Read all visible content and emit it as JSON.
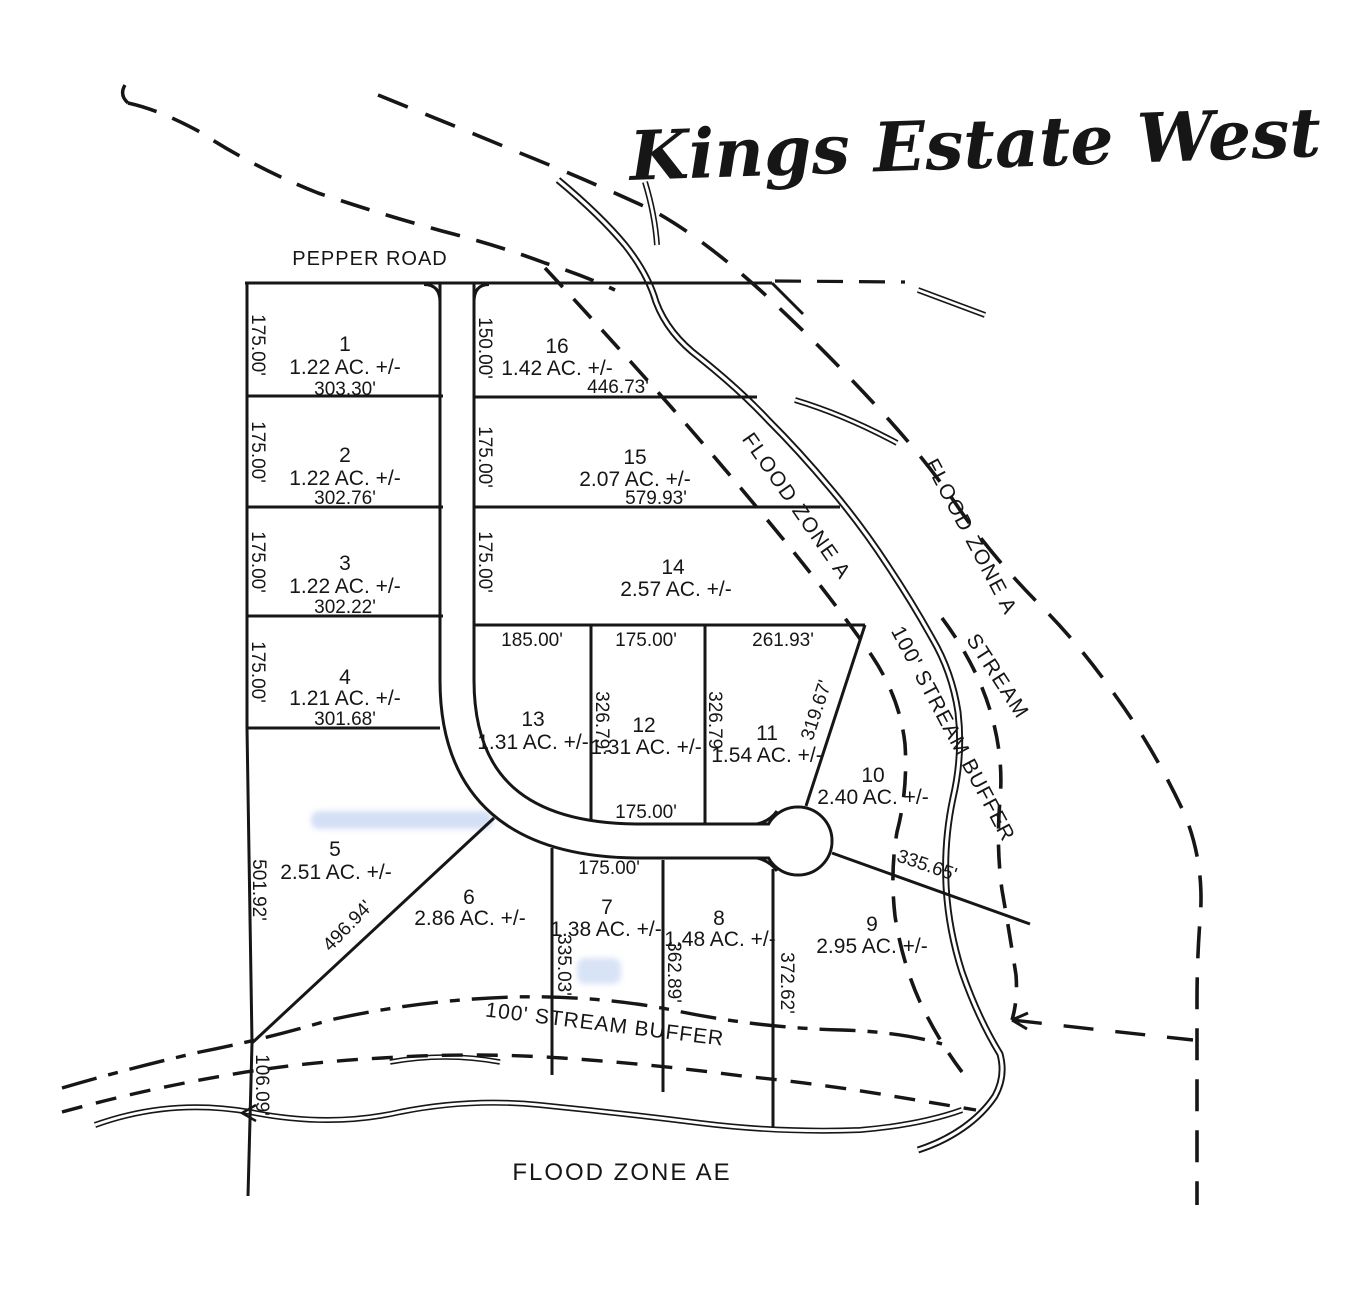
{
  "title": "Kings Estate West",
  "road_label": "PEPPER ROAD",
  "zones": {
    "flood_zone_a_west": "FLOOD ZONE A",
    "flood_zone_a_east": "FLOOD ZONE A",
    "flood_zone_ae": "FLOOD ZONE AE",
    "stream": "STREAM",
    "stream_buffer_ne": "100' STREAM BUFFER",
    "stream_buffer_south": "100' STREAM BUFFER"
  },
  "colors": {
    "ink": "#161616",
    "paper": "#ffffff",
    "smudge_blue": "#8cace4"
  },
  "lots": [
    {
      "number": "1",
      "area": "1.22 AC. +/-"
    },
    {
      "number": "2",
      "area": "1.22 AC. +/-"
    },
    {
      "number": "3",
      "area": "1.22 AC. +/-"
    },
    {
      "number": "4",
      "area": "1.21 AC. +/-"
    },
    {
      "number": "5",
      "area": "2.51 AC. +/-"
    },
    {
      "number": "6",
      "area": "2.86 AC. +/-"
    },
    {
      "number": "7",
      "area": "1.38 AC. +/-"
    },
    {
      "number": "8",
      "area": "1.48 AC. +/-"
    },
    {
      "number": "9",
      "area": "2.95 AC. +/-"
    },
    {
      "number": "10",
      "area": "2.40 AC. +/-"
    },
    {
      "number": "11",
      "area": "1.54 AC. +/-"
    },
    {
      "number": "12",
      "area": "1.31 AC. +/-"
    },
    {
      "number": "13",
      "area": "1.31 AC. +/-"
    },
    {
      "number": "14",
      "area": "2.57 AC. +/-"
    },
    {
      "number": "15",
      "area": "2.07 AC. +/-"
    },
    {
      "number": "16",
      "area": "1.42 AC. +/-"
    }
  ],
  "dims": {
    "lot1_west": "175.00'",
    "lot1_south": "303.30'",
    "lot2_west": "175.00'",
    "lot2_south": "302.76'",
    "lot3_west": "175.00'",
    "lot3_south": "302.22'",
    "lot4_west": "175.00'",
    "lot4_south": "301.68'",
    "lot5_west": "501.92'",
    "lot5_diagonal": "496.94'",
    "boundary_south": "106.09'",
    "lot16_west": "150.00'",
    "lot16_south": "446.73'",
    "lot15_west": "175.00'",
    "lot15_south": "579.93'",
    "lot14_west": "175.00'",
    "lot13_north": "185.00'",
    "lot12_north": "175.00'",
    "lot12_west": "326.79'",
    "lot12_south": "175.00'",
    "lot11_north": "261.93'",
    "lot11_west": "326.79'",
    "lot11_east": "319.67'",
    "lot7_north": "175.00'",
    "lot7_west": "335.03'",
    "lot8_west": "362.89'",
    "lot8_east": "372.62'",
    "lot9_north": "335.65'"
  }
}
